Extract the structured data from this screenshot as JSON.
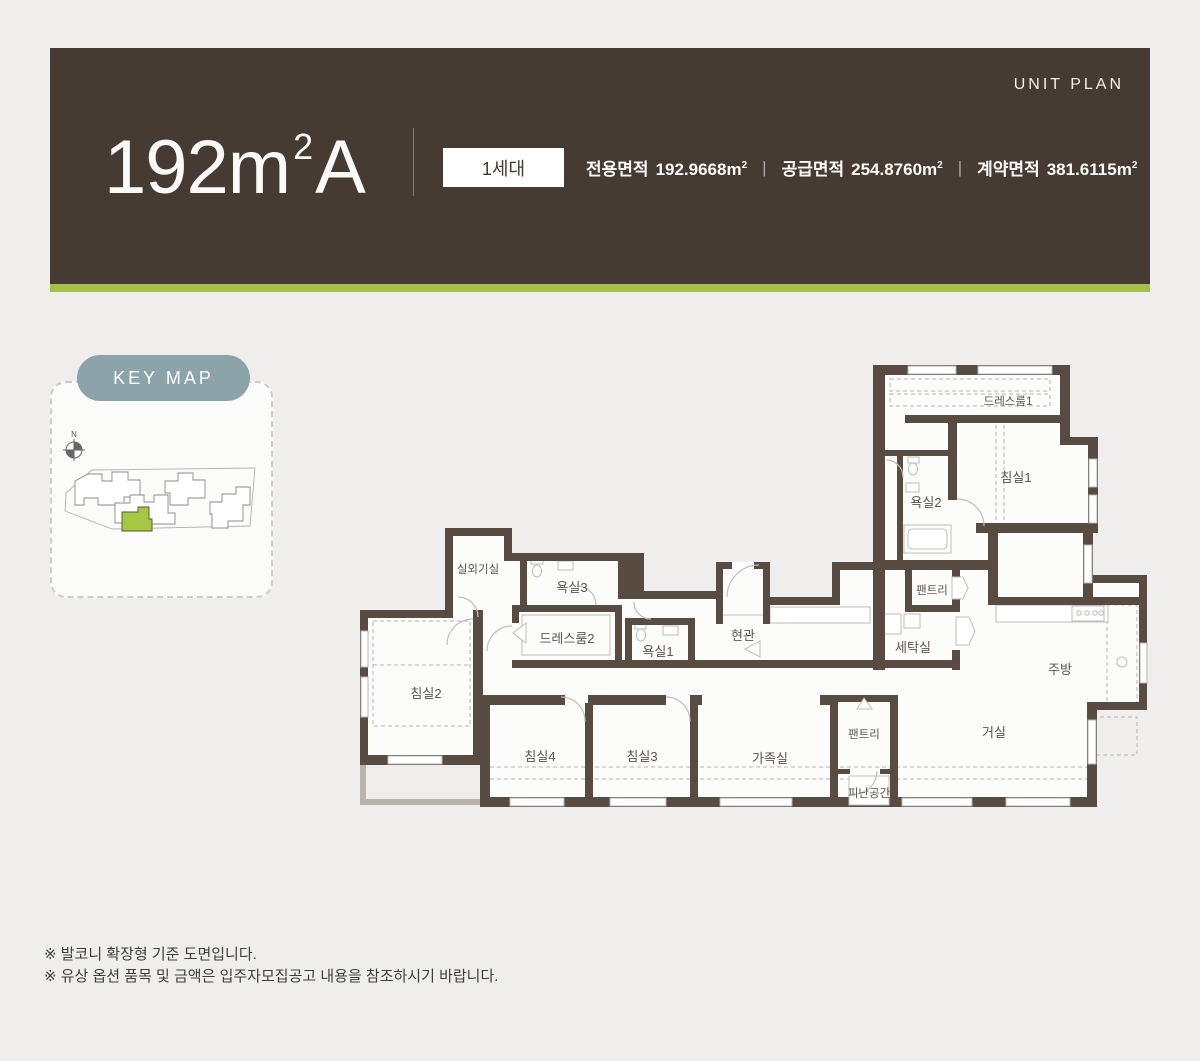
{
  "header": {
    "unit_plan_label": "UNIT PLAN",
    "title_main": "192m",
    "title_sup": "2",
    "title_suffix": "A",
    "badge": "1세대",
    "separator": "|",
    "areas": [
      {
        "label": "전용면적",
        "value": "192.9668",
        "unit_m": "m",
        "unit_sup": "2"
      },
      {
        "label": "공급면적",
        "value": "254.8760",
        "unit_m": "m",
        "unit_sup": "2"
      },
      {
        "label": "계약면적",
        "value": "381.6115",
        "unit_m": "m",
        "unit_sup": "2"
      }
    ]
  },
  "keymap": {
    "label": "KEY MAP",
    "compass_n": "N"
  },
  "plan": {
    "rooms": [
      {
        "label": "드레스룸1"
      },
      {
        "label": "침실1"
      },
      {
        "label": "욕실2"
      },
      {
        "label": "팬트리"
      },
      {
        "label": "세탁실"
      },
      {
        "label": "주방"
      },
      {
        "label": "현관"
      },
      {
        "label": "욕실1"
      },
      {
        "label": "드레스룸2"
      },
      {
        "label": "욕실3"
      },
      {
        "label": "실외기실"
      },
      {
        "label": "침실2"
      },
      {
        "label": "침실4"
      },
      {
        "label": "침실3"
      },
      {
        "label": "가족실"
      },
      {
        "label": "팬트리"
      },
      {
        "label": "피난공간"
      },
      {
        "label": "거실"
      }
    ]
  },
  "notes": [
    "※ 발코니 확장형 기준 도면입니다.",
    "※ 유상 옵션 품목 및 금액은 입주자모집공고 내용을 참조하시기 바랍니다."
  ],
  "colors": {
    "header_bg": "#463b33",
    "accent_green": "#a3c14a",
    "keymap_pill": "#8ba3a9",
    "keymap_highlight": "#a5c843",
    "wall": "#584b42"
  }
}
